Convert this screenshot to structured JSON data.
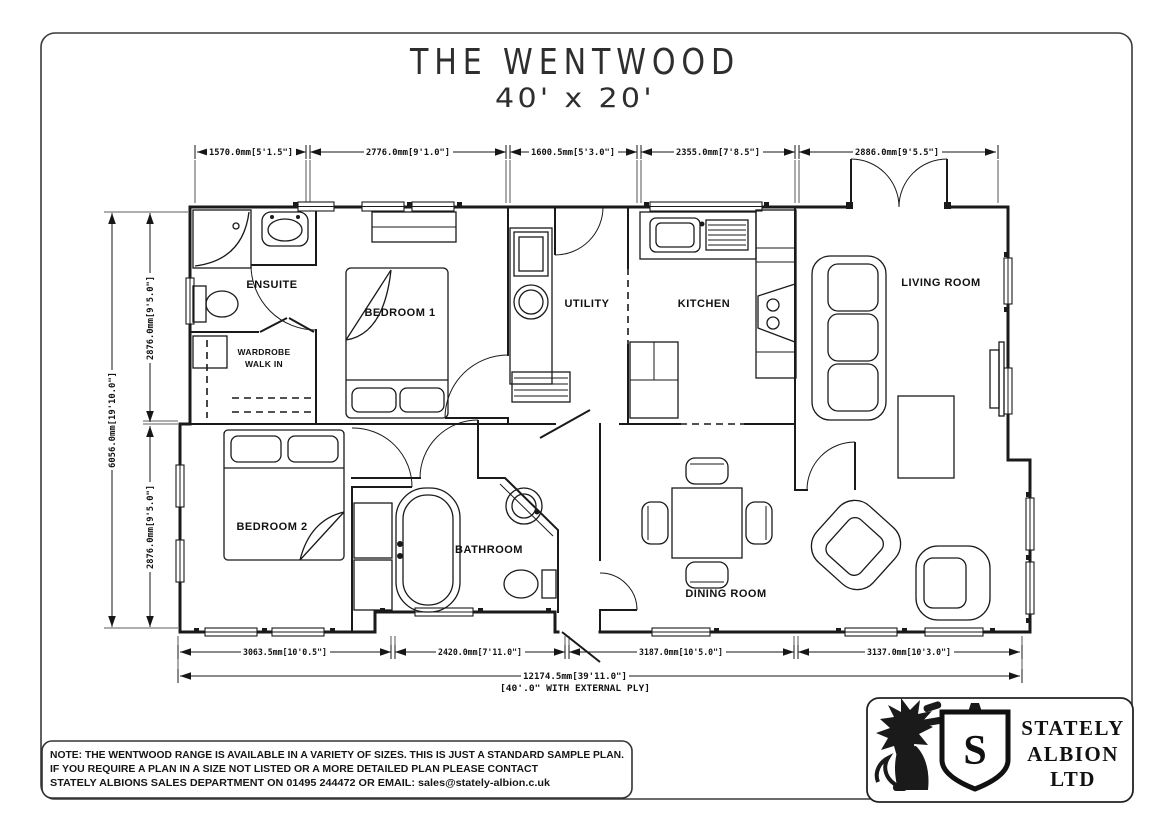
{
  "title": {
    "name": "THE WENTWOOD",
    "size": "40' x 20'"
  },
  "dimensions": {
    "top": [
      "1570.0mm[5'1.5\"]",
      "2776.0mm[9'1.0\"]",
      "1600.5mm[5'3.0\"]",
      "2355.0mm[7'8.5\"]",
      "2886.0mm[9'5.5\"]"
    ],
    "left_overall": "6056.0mm[19'10.0\"]",
    "left_upper": "2876.0mm[9'5.0\"]",
    "left_lower": "2876.0mm[9'5.0\"]",
    "bottom": [
      "3063.5mm[10'0.5\"]",
      "2420.0mm[7'11.0\"]",
      "3187.0mm[10'5.0\"]",
      "3137.0mm[10'3.0\"]"
    ],
    "overall": "12174.5mm[39'11.0\"]",
    "overall_note": "[40'.0\" WITH EXTERNAL PLY]"
  },
  "rooms": {
    "ensuite": "ENSUITE",
    "wardrobe_line1": "WARDROBE",
    "wardrobe_line2": "WALK IN",
    "bedroom1": "BEDROOM 1",
    "utility": "UTILITY",
    "kitchen": "KITCHEN",
    "living": "LIVING ROOM",
    "bedroom2": "BEDROOM 2",
    "bathroom": "BATHROOM",
    "dining": "DINING ROOM"
  },
  "note": {
    "line1": "NOTE: THE WENTWOOD RANGE IS AVAILABLE IN A VARIETY OF SIZES. THIS IS JUST A STANDARD SAMPLE PLAN.",
    "line2": "IF YOU REQUIRE A PLAN IN A SIZE NOT LISTED OR A MORE DETAILED PLAN PLEASE CONTACT",
    "line3": "STATELY ALBIONS SALES DEPARTMENT ON 01495 244472 OR EMAIL: sales@stately-albion.c.uk"
  },
  "logo": {
    "shield_letter": "S",
    "line1": "STATELY",
    "line2": "ALBION",
    "line3": "LTD"
  },
  "colors": {
    "ink": "#1a1a1a",
    "paper": "#ffffff"
  }
}
